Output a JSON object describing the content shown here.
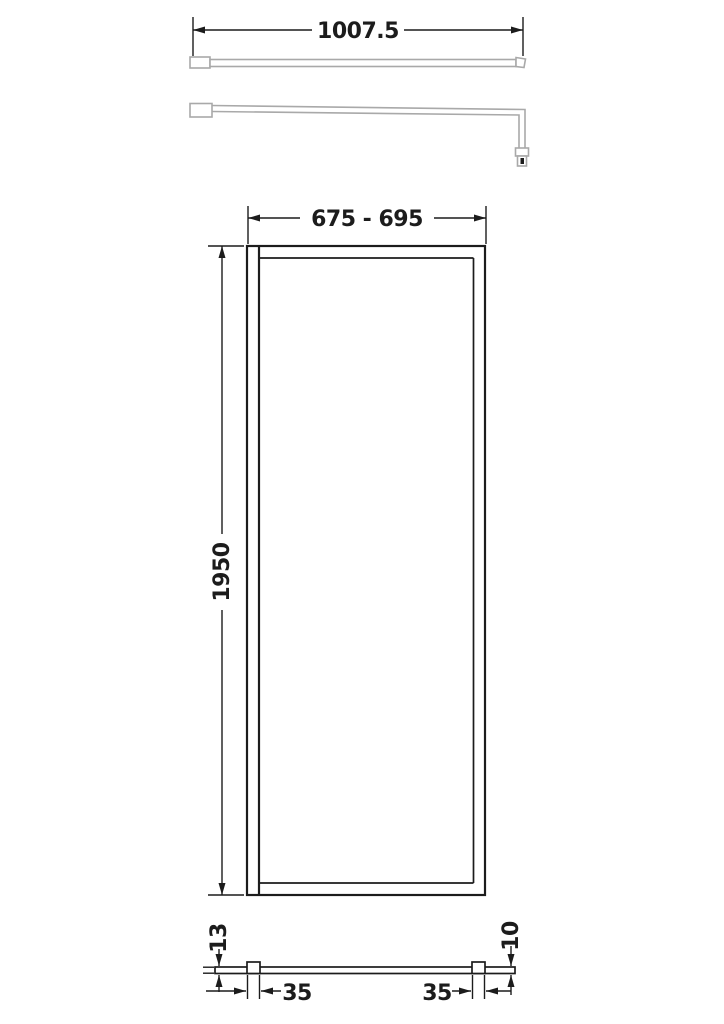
{
  "colors": {
    "line": "#1c1c1c",
    "hardware": "#a9a9a9",
    "background": "#ffffff"
  },
  "dimensions": {
    "support_bar_length": "1007.5",
    "adjustment_width": "675 - 695",
    "panel_height": "1950",
    "wall_profile_depth": "13",
    "glass_thickness": "10",
    "offset_left": "35",
    "offset_right": "35"
  }
}
